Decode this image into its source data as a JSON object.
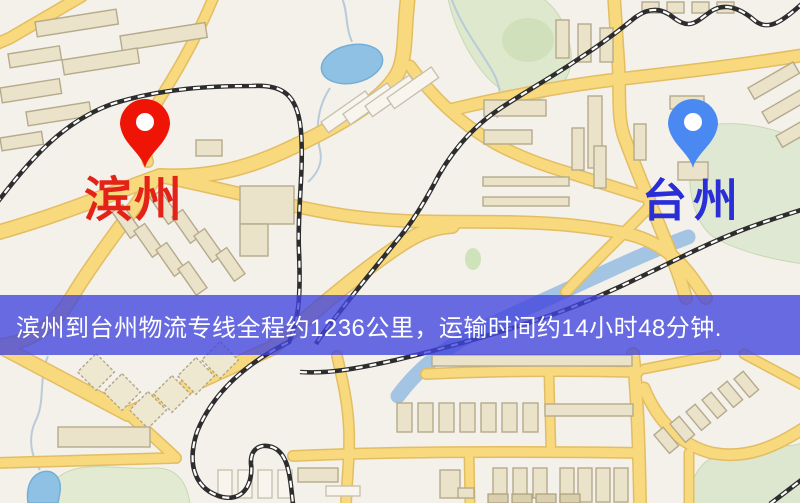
{
  "banner": {
    "text": "滨州到台州物流专线全程约1236公里，运输时间约14小时48分钟.",
    "bg_color": "#4044de",
    "text_color": "#ffffff",
    "distance_km": "1236",
    "duration": "14小时48分钟"
  },
  "markers": {
    "origin": {
      "label": "滨州",
      "pin_color": "#ee1506",
      "label_color": "#e42318"
    },
    "destination": {
      "label": "台州",
      "pin_color": "#4b89f2",
      "label_color": "#2a2ed6"
    }
  },
  "map": {
    "style_colors": {
      "background": "#f4f0ea",
      "road_fill": "#f8d97e",
      "road_casing": "#e3bd62",
      "building": "#ebe3c9",
      "water": "#8fc1e4",
      "park_green": "#dde8cc",
      "railway": "#2d2d2d"
    }
  }
}
